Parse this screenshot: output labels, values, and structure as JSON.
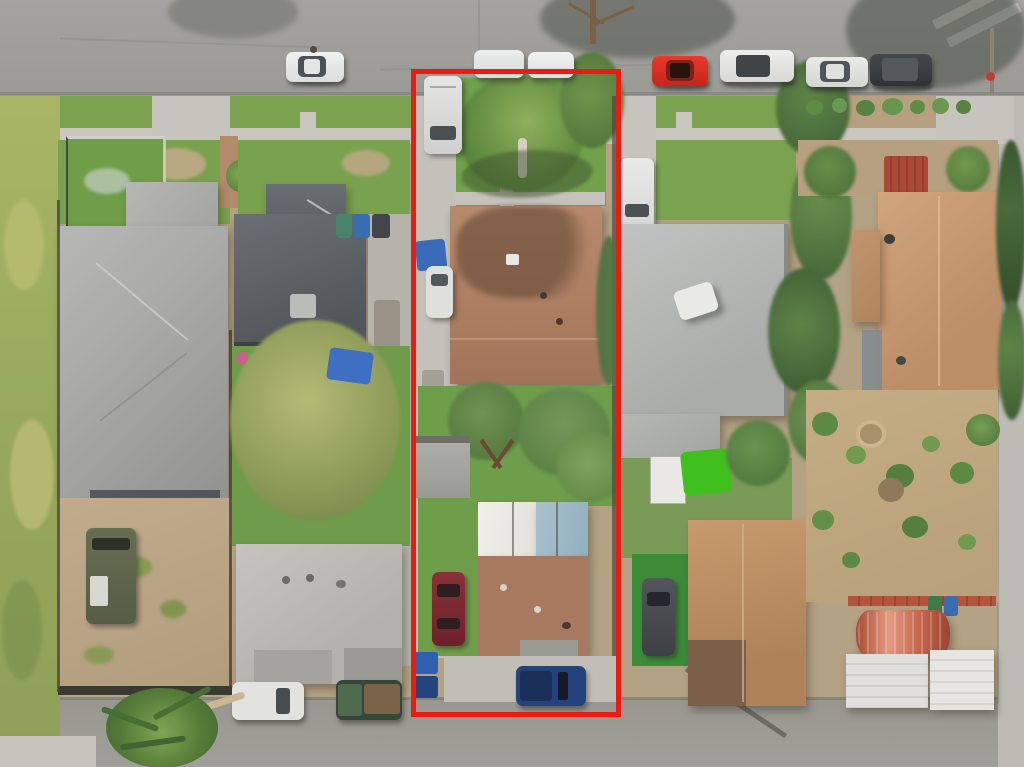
{
  "scene": {
    "type": "aerial-drone-photograph",
    "description": "Overhead (top-down) aerial photo of a suburban residential block. A red rectangular boundary outlines a long, narrow subject lot containing a front house with a brown shingle roof, a rear unit with white/blue metal and brown roofing, lawns, trees, a driveway with parked vehicles, and trash bins. Neighboring lots show gray-roofed houses, dirt yards, landscaped gardens, streets with parked cars, sidewalks and mature trees.",
    "orientation": "top-down",
    "no_visible_text": true
  },
  "outline": {
    "label": "subject-property-boundary",
    "color": "#ec1a10",
    "shape": "rectangle"
  },
  "palette": {
    "asphalt_road": "#9f9e9a",
    "concrete": "#c9c7bf",
    "lawn_green": "#74a24c",
    "weedy_green": "#a3b166",
    "dirt_tan": "#bba584",
    "subject_roof_brown": "#b28266",
    "rear_unit_metal_white": "#eeede9",
    "rear_unit_metal_blue": "#9fbac6",
    "left_house_roof_gray": "#a8a8a6",
    "dark_roof_slate": "#5f6366",
    "neighbor_roof_light_gray": "#b2b5b3",
    "far_right_roof_tan": "#c79a74",
    "quonset_red": "#c96a50",
    "bright_green_tarp": "#3fc01e",
    "blue_tarp": "#3e6fc2"
  },
  "objects": {
    "streets": [
      "top street (east-west) with parked cars",
      "bottom street (east-west)",
      "right-edge side street"
    ],
    "crosswalk": "white striped crosswalk at top-right corner",
    "parked_cars_top_street": [
      "white sedan",
      "white van",
      "white van",
      "red sports car",
      "white SUV",
      "white sedan",
      "dark gray SUV"
    ],
    "subject_lot": [
      "white van in front driveway",
      "front lawn with palm tree",
      "brown-roof main house",
      "blue tarp and white car beside driveway",
      "backyard trees and gray shed",
      "rear unit with white/blue metal roof and brown roof",
      "maroon car on lawn",
      "dark blue pickup at rear",
      "blue trash bins"
    ],
    "left_lots": [
      "fenced garden lawn",
      "large light-gray hip-roof house",
      "dark slate-roof house with blue tarps",
      "large sage-green tree",
      "dirt yard with army-green truck",
      "pale-gray hip-roof house",
      "white pickup",
      "green truck with load",
      "palm tree over bottom street"
    ],
    "right_lots": [
      "white pickup in driveway",
      "light-gray roof house",
      "white shed and bright green tarp",
      "artificial turf with dark gray car",
      "tan-roof rear house",
      "tan cross-gable house with red deck",
      "xeriscaped garden with shrubs",
      "red quonset-roof carport",
      "white metal canopy",
      "row of shrubs along parkway"
    ]
  }
}
